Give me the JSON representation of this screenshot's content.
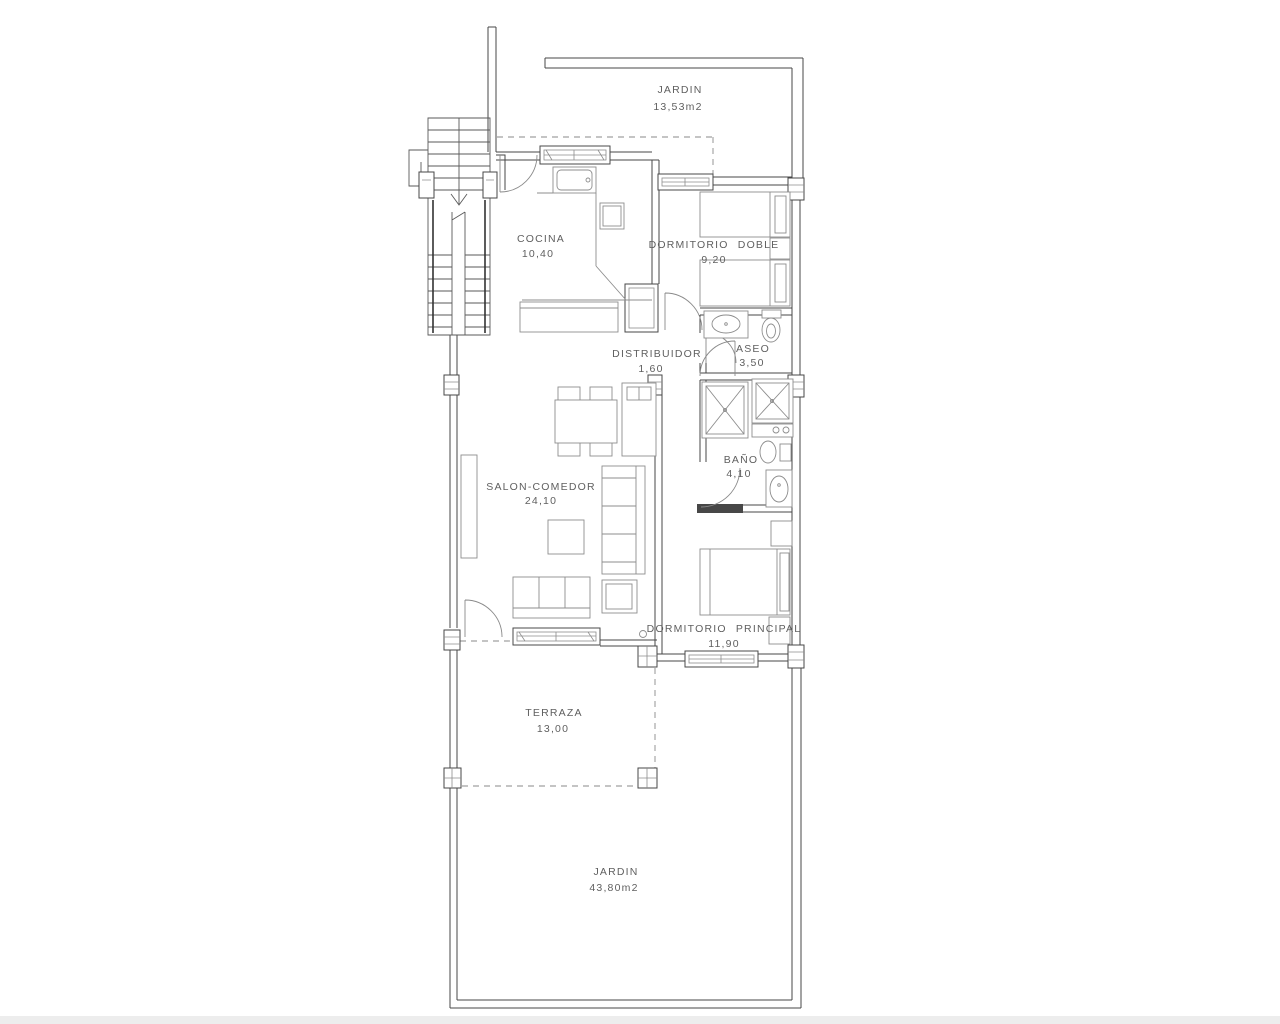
{
  "title": "Apartment floor plan",
  "colors": {
    "background": "#ffffff",
    "wall": "#474747",
    "furniture": "#8d8d8d",
    "label_text": "#5f5f5f"
  },
  "rooms": {
    "jardin_top": {
      "name": "JARDIN",
      "area": "13,53m2"
    },
    "cocina": {
      "name": "COCINA",
      "area": "10,40"
    },
    "dormitorio_doble": {
      "name": "DORMITORIO DOBLE",
      "area": "9,20"
    },
    "distribuidor": {
      "name": "DISTRIBUIDOR",
      "area": "1,60"
    },
    "aseo": {
      "name": "ASEO",
      "area": "3,50"
    },
    "bano": {
      "name": "BAÑO",
      "area": "4,10"
    },
    "salon_comedor": {
      "name": "SALON-COMEDOR",
      "area": "24,10"
    },
    "dormitorio_principal": {
      "name": "DORMITORIO PRINCIPAL",
      "area": "11,90"
    },
    "terraza": {
      "name": "TERRAZA",
      "area": "13,00"
    },
    "jardin_bottom": {
      "name": "JARDIN",
      "area": "43,80m2"
    }
  }
}
